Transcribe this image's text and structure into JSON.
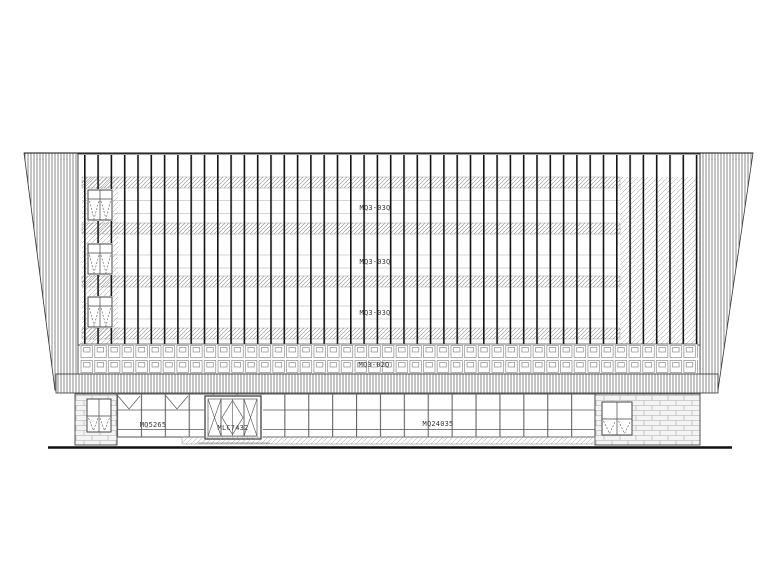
{
  "curtain_wall": {
    "floor_labels": [
      "MQ3-03Q",
      "MQ3-03Q",
      "MQ3-03Q"
    ],
    "spandrel_band_label": "MQ3-02Q"
  },
  "ground_floor": {
    "storefront_left_label": "MQ5265",
    "door_label": "MLC7432",
    "storefront_right_label": "MQ24035"
  },
  "colors": {
    "line": "#1a1a1a",
    "hatch": "#8a8a8a",
    "brick_bg": "#f4f4f4",
    "paper": "#ffffff"
  }
}
